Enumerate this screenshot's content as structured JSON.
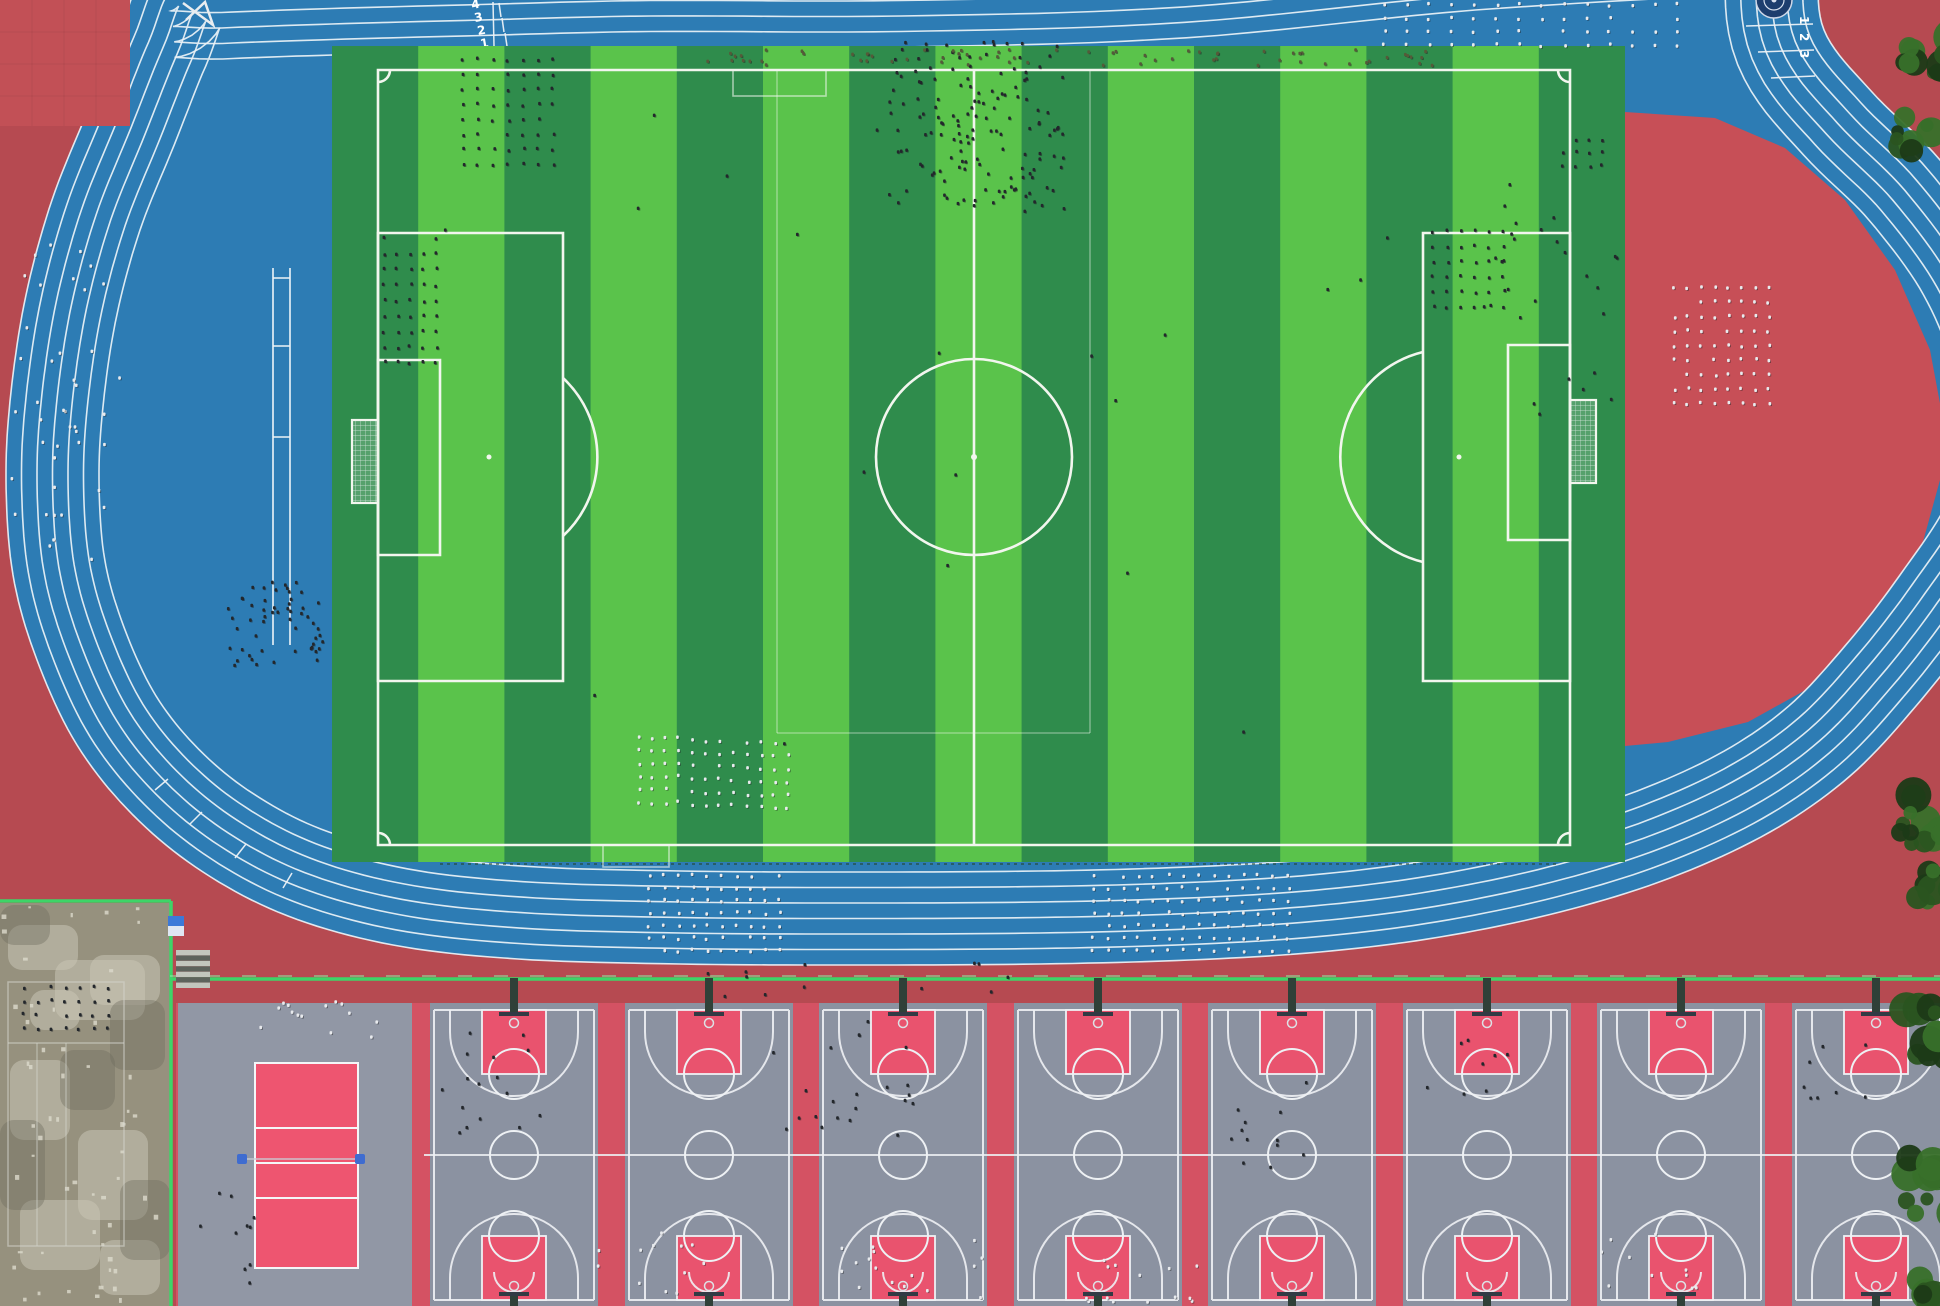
{
  "meta": {
    "kind": "aerial-drone-photo",
    "subject": "school sports complex: blue running track, striped soccer field, basketball courts"
  },
  "palette": {
    "ground_red": "#b64a51",
    "plaza_red": "#c25056",
    "infield_red": "#c74f57",
    "track_blue": "#2d7cb4",
    "lane_line": "#edf3f7",
    "grass_light": "#5ac34b",
    "grass_dark": "#2f8c4c",
    "field_line": "#f2f6ee",
    "court_gray": "#8b92a1",
    "key_pink": "#e9536e",
    "zone_pink": "#d45263",
    "vb_gray": "#9197a5",
    "vb_pink": "#ee5570",
    "post_blue": "#3f6cd0",
    "fence_green": "#3ed468",
    "concrete": "#96917e",
    "person_dark": "#23272c",
    "person_light": "#e8eaed",
    "person_olive": "#555a39",
    "tree_dark": "#1c3a17",
    "tree_mid": "#2a5420",
    "tree_light": "#38702a"
  },
  "track": {
    "lane_count": 6,
    "lane_width": 15.5,
    "outer_boundary": [
      [
        650,
        -46
      ],
      [
        480,
        -42
      ],
      [
        330,
        -38
      ],
      [
        220,
        -34
      ],
      [
        150,
        -30
      ],
      [
        120,
        30
      ],
      [
        88,
        110
      ],
      [
        52,
        200
      ],
      [
        26,
        295
      ],
      [
        11,
        392
      ],
      [
        6,
        480
      ],
      [
        13,
        575
      ],
      [
        37,
        660
      ],
      [
        77,
        745
      ],
      [
        133,
        815
      ],
      [
        203,
        872
      ],
      [
        288,
        916
      ],
      [
        393,
        945
      ],
      [
        518,
        959
      ],
      [
        680,
        964
      ],
      [
        860,
        965
      ],
      [
        1040,
        964
      ],
      [
        1190,
        960
      ],
      [
        1320,
        952
      ],
      [
        1440,
        937
      ],
      [
        1560,
        912
      ],
      [
        1670,
        878
      ],
      [
        1770,
        832
      ],
      [
        1850,
        776
      ],
      [
        1916,
        706
      ],
      [
        1975,
        630
      ],
      [
        2030,
        545
      ],
      [
        2058,
        455
      ],
      [
        2045,
        350
      ],
      [
        2005,
        250
      ],
      [
        1940,
        160
      ],
      [
        1872,
        92
      ],
      [
        1824,
        30
      ],
      [
        1818,
        -40
      ],
      [
        1815,
        -95
      ],
      [
        1500,
        -85
      ],
      [
        1180,
        -55
      ],
      [
        900,
        -46
      ]
    ],
    "infield_red_segment": [
      [
        1625,
        112
      ],
      [
        1715,
        118
      ],
      [
        1785,
        148
      ],
      [
        1845,
        200
      ],
      [
        1895,
        270
      ],
      [
        1930,
        350
      ],
      [
        1945,
        430
      ],
      [
        1940,
        480
      ],
      [
        1918,
        560
      ],
      [
        1878,
        628
      ],
      [
        1820,
        682
      ],
      [
        1748,
        722
      ],
      [
        1668,
        742
      ],
      [
        1625,
        746
      ]
    ],
    "start_ticks": [
      [
        499,
        3,
        501,
        17
      ],
      [
        502,
        18,
        504,
        32
      ],
      [
        505,
        33,
        507,
        46
      ],
      [
        493,
        2,
        494,
        46
      ],
      [
        540,
        118,
        556,
        125
      ],
      [
        573,
        180,
        590,
        186
      ],
      [
        610,
        240,
        628,
        245
      ],
      [
        652,
        295,
        668,
        299
      ],
      [
        697,
        343,
        711,
        346
      ],
      [
        155,
        790,
        168,
        779
      ],
      [
        190,
        824,
        202,
        812
      ],
      [
        235,
        858,
        246,
        844
      ],
      [
        283,
        888,
        292,
        873
      ],
      [
        1746,
        26,
        1813,
        24
      ],
      [
        1758,
        52,
        1814,
        50
      ],
      [
        1771,
        78,
        1815,
        76
      ]
    ],
    "lane_numbers_top_left": [
      "4",
      "3",
      "2",
      "1"
    ],
    "lane_numbers_top_right": [
      "1",
      "2",
      "3"
    ],
    "runway": {
      "x1": 273,
      "x2": 290,
      "y1": 268,
      "y2": 645,
      "bars": [
        278,
        346,
        437
      ]
    },
    "equipment": [
      [
        183,
        3
      ],
      [
        213,
        25
      ],
      [
        205,
        2
      ],
      [
        186,
        20
      ]
    ]
  },
  "emblem": {
    "cx": 1774,
    "cy": 0,
    "r": 18,
    "color": "#1d3e6e"
  },
  "plaza": {
    "square": [
      0,
      0,
      130,
      126
    ]
  },
  "field": {
    "grass": [
      332,
      46,
      1293,
      816
    ],
    "stripe_width": 86.2,
    "bounds": [
      378,
      70,
      1570,
      845
    ],
    "center": [
      974,
      457
    ],
    "circle_r": 98,
    "penalty_left": [
      378,
      233,
      563,
      681
    ],
    "goal_box_left": [
      378,
      360,
      440,
      555
    ],
    "goal_left": [
      352,
      420,
      378,
      503
    ],
    "penalty_right": [
      1423,
      233,
      1570,
      681
    ],
    "goal_box_right": [
      1508,
      345,
      1570,
      540
    ],
    "goal_right": [
      1570,
      400,
      1596,
      483
    ],
    "penalty_arc_left": "M563,378 A108,108 0 0 1 563,536",
    "penalty_arc_right": "M1423,562 A108,108 0 0 1 1423,352",
    "mini_boxes": [
      [
        733,
        70,
        93,
        26
      ],
      [
        603,
        845,
        66,
        22
      ]
    ],
    "training_lines": {
      "v": [
        777,
        1090
      ],
      "y_top": 70,
      "y_bot": 733
    }
  },
  "south": {
    "fence_y": 979,
    "concrete_fence_y": 901,
    "fence_x_split": 171,
    "concrete": {
      "rect": [
        0,
        903,
        170,
        403
      ],
      "court_lines": {
        "outer": [
          8,
          982,
          116,
          264
        ],
        "h": 1043,
        "v": [
          37,
          66
        ]
      },
      "light_patches": [
        [
          8,
          925,
          70,
          45
        ],
        [
          55,
          960,
          90,
          60
        ],
        [
          10,
          1060,
          60,
          80
        ],
        [
          78,
          1130,
          70,
          90
        ],
        [
          20,
          1200,
          80,
          70
        ],
        [
          90,
          955,
          70,
          50
        ],
        [
          100,
          1240,
          60,
          55
        ],
        [
          30,
          990,
          50,
          40
        ]
      ],
      "dark_patches": [
        [
          0,
          905,
          50,
          40
        ],
        [
          110,
          1000,
          55,
          70
        ],
        [
          0,
          1120,
          45,
          90
        ],
        [
          60,
          1050,
          55,
          60
        ],
        [
          120,
          1180,
          50,
          80
        ]
      ]
    },
    "stairs": [
      176,
      950,
      34,
      38
    ],
    "sign": [
      168,
      916,
      16,
      20
    ],
    "zone_rect": [
      176,
      1003,
      1764,
      303
    ],
    "volleyball": {
      "rect": [
        178,
        1003,
        234,
        303
      ],
      "court": [
        255,
        1063,
        103,
        205
      ],
      "lines_y": [
        1128,
        1163,
        1198
      ],
      "post_y": 1159,
      "post_x": [
        242,
        360
      ]
    },
    "basketball": {
      "lefts": [
        430,
        625,
        819,
        1014,
        1208,
        1403,
        1597,
        1792
      ],
      "width": 168,
      "top": 1003,
      "bottom": 1306,
      "half_y": 1155
    }
  },
  "trees": [
    [
      1930,
      62,
      10,
      58
    ],
    [
      1916,
      135,
      8,
      42
    ],
    [
      1914,
      818,
      12,
      62
    ],
    [
      1936,
      884,
      8,
      40
    ],
    [
      1922,
      1032,
      10,
      50
    ],
    [
      1930,
      1185,
      11,
      58
    ],
    [
      1935,
      1292,
      6,
      32
    ]
  ],
  "clusters": [
    {
      "name": "crowd-left-red",
      "type": "scatter",
      "x": 5,
      "y": 235,
      "w": 115,
      "h": 330,
      "n": 42,
      "color": "light",
      "seed": 11
    },
    {
      "name": "formation-field-topleft",
      "type": "grid",
      "x": 462,
      "y": 58,
      "cols": 7,
      "rows": 8,
      "dx": 15,
      "dy": 15,
      "color": "dark",
      "seed": 12
    },
    {
      "name": "formation-left-penalty",
      "type": "grid",
      "x": 383,
      "y": 237,
      "cols": 5,
      "rows": 9,
      "dx": 13,
      "dy": 15.5,
      "color": "dark",
      "seed": 13
    },
    {
      "name": "crowd-field-topcenter",
      "type": "scatter",
      "x": 888,
      "y": 40,
      "w": 175,
      "h": 170,
      "n": 150,
      "color": "dark",
      "seed": 14
    },
    {
      "name": "row-top-touchline",
      "type": "scatter",
      "x": 690,
      "y": 48,
      "w": 760,
      "h": 16,
      "n": 70,
      "color": "olive",
      "seed": 15
    },
    {
      "name": "formation-field-right",
      "type": "grid",
      "x": 1432,
      "y": 230,
      "cols": 6,
      "rows": 6,
      "dx": 14,
      "dy": 15,
      "color": "dark",
      "seed": 16
    },
    {
      "name": "formation-red-segment",
      "type": "grid",
      "x": 1673,
      "y": 286,
      "cols": 8,
      "rows": 9,
      "dx": 13.5,
      "dy": 14.5,
      "color": "light",
      "seed": 17
    },
    {
      "name": "rows-track-topright",
      "type": "grid",
      "x": 1383,
      "y": 3,
      "cols": 14,
      "rows": 4,
      "dx": 22.5,
      "dy": 13.5,
      "color": "light",
      "seed": 18
    },
    {
      "name": "cluster-field-topright",
      "type": "grid",
      "x": 1562,
      "y": 138,
      "cols": 4,
      "rows": 3,
      "dx": 13,
      "dy": 13,
      "color": "dark",
      "seed": 19
    },
    {
      "name": "scatter-field-right-edge",
      "type": "scatter",
      "x": 1480,
      "y": 182,
      "w": 140,
      "h": 240,
      "n": 26,
      "color": "dark",
      "seed": 20
    },
    {
      "name": "formation-field-bottom-a",
      "type": "grid",
      "x": 638,
      "y": 736,
      "cols": 4,
      "rows": 6,
      "dx": 13,
      "dy": 13,
      "color": "light",
      "seed": 21
    },
    {
      "name": "formation-field-bottom-b",
      "type": "grid",
      "x": 692,
      "y": 739,
      "cols": 4,
      "rows": 6,
      "dx": 13,
      "dy": 13,
      "color": "light",
      "seed": 22
    },
    {
      "name": "formation-field-bottom-c",
      "type": "grid",
      "x": 747,
      "y": 741,
      "cols": 4,
      "rows": 6,
      "dx": 13,
      "dy": 13,
      "color": "light",
      "seed": 23
    },
    {
      "name": "crowd-runway-end",
      "type": "scatter",
      "x": 222,
      "y": 578,
      "w": 100,
      "h": 88,
      "n": 55,
      "color": "dark",
      "seed": 24
    },
    {
      "name": "formation-track-bottom-a",
      "type": "grid",
      "x": 648,
      "y": 874,
      "cols": 10,
      "rows": 7,
      "dx": 14.5,
      "dy": 12.5,
      "color": "light",
      "seed": 25
    },
    {
      "name": "formation-track-bottom-b",
      "type": "grid",
      "x": 1092,
      "y": 874,
      "cols": 14,
      "rows": 7,
      "dx": 15,
      "dy": 12.5,
      "color": "light",
      "seed": 26
    },
    {
      "name": "scatter-field-sparse",
      "type": "scatter",
      "x": 420,
      "y": 110,
      "w": 1130,
      "h": 700,
      "n": 20,
      "color": "dark",
      "seed": 27
    },
    {
      "name": "scatter-red-strip",
      "type": "scatter",
      "x": 640,
      "y": 960,
      "w": 380,
      "h": 36,
      "n": 12,
      "color": "dark",
      "seed": 28
    },
    {
      "name": "scatter-volleyball-top",
      "type": "scatter",
      "x": 250,
      "y": 1000,
      "w": 130,
      "h": 42,
      "n": 14,
      "color": "light",
      "seed": 29
    },
    {
      "name": "scatter-volleyball-left",
      "type": "scatter",
      "x": 188,
      "y": 1168,
      "w": 70,
      "h": 130,
      "n": 10,
      "color": "dark",
      "seed": 30
    },
    {
      "name": "rows-concrete",
      "type": "grid",
      "x": 22,
      "y": 986,
      "cols": 7,
      "rows": 4,
      "dx": 14,
      "dy": 13.5,
      "color": "dark",
      "seed": 31
    },
    {
      "name": "scatter-court1",
      "type": "scatter",
      "x": 440,
      "y": 1018,
      "w": 100,
      "h": 125,
      "n": 16,
      "color": "dark",
      "seed": 32
    },
    {
      "name": "scatter-court2-3",
      "type": "scatter",
      "x": 758,
      "y": 1018,
      "w": 175,
      "h": 120,
      "n": 22,
      "color": "dark",
      "seed": 33
    },
    {
      "name": "scatter-court3-bottom",
      "type": "scatter",
      "x": 838,
      "y": 1238,
      "w": 145,
      "h": 62,
      "n": 16,
      "color": "light",
      "seed": 34
    },
    {
      "name": "scatter-court1-bottom",
      "type": "scatter",
      "x": 596,
      "y": 1228,
      "w": 110,
      "h": 72,
      "n": 12,
      "color": "light",
      "seed": 35
    },
    {
      "name": "scatter-court4-bottom",
      "type": "scatter",
      "x": 1076,
      "y": 1258,
      "w": 120,
      "h": 44,
      "n": 14,
      "color": "light",
      "seed": 36
    },
    {
      "name": "scatter-court5",
      "type": "scatter",
      "x": 1228,
      "y": 1056,
      "w": 80,
      "h": 110,
      "n": 12,
      "color": "dark",
      "seed": 37
    },
    {
      "name": "scatter-court6",
      "type": "scatter",
      "x": 1420,
      "y": 1030,
      "w": 90,
      "h": 70,
      "n": 8,
      "color": "dark",
      "seed": 38
    },
    {
      "name": "scatter-court7-bottom",
      "type": "scatter",
      "x": 1600,
      "y": 1230,
      "w": 100,
      "h": 72,
      "n": 10,
      "color": "light",
      "seed": 39
    },
    {
      "name": "scatter-court8",
      "type": "scatter",
      "x": 1800,
      "y": 1030,
      "w": 100,
      "h": 80,
      "n": 8,
      "color": "dark",
      "seed": 40
    }
  ]
}
